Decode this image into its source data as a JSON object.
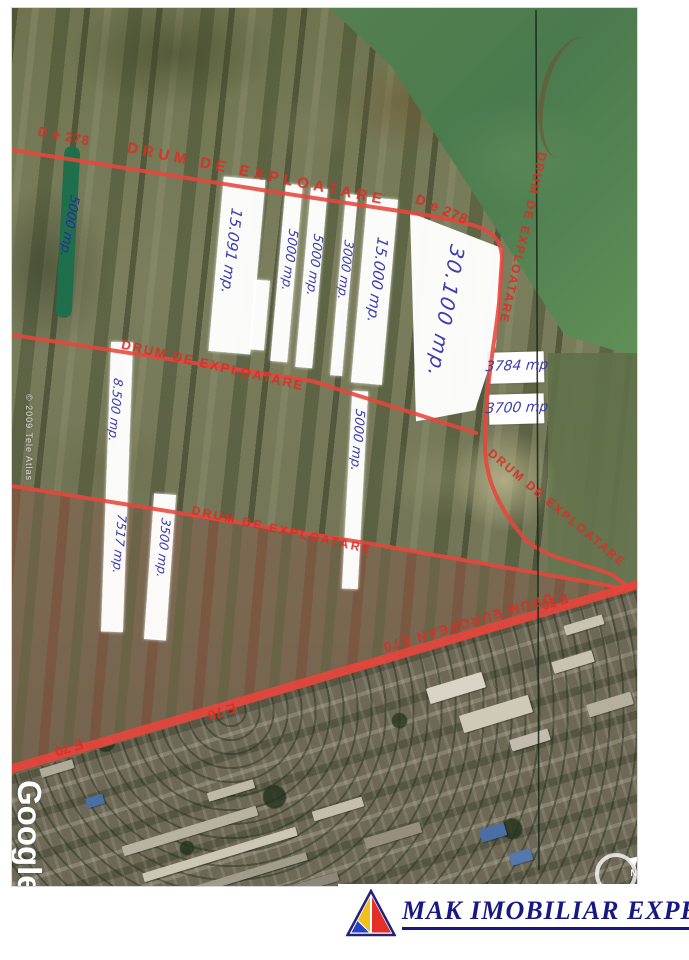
{
  "page": {
    "footer": {
      "company": "MAK IMOBILIAR EXPERT"
    },
    "map": {
      "watermark_copyright": "© 2009 Tele Atlas",
      "watermark_brand": "Google",
      "compass_north": "N",
      "road_labels": [
        {
          "id": "de278-left",
          "text": "D e 278"
        },
        {
          "id": "top-road",
          "text": "DRUM DE EXPLOATARE"
        },
        {
          "id": "de278-top-right",
          "text": "D e 278"
        },
        {
          "id": "right-vertical",
          "text": "DRUM DE EXPLOATARE"
        },
        {
          "id": "middle-road",
          "text": "DRUM DE EXPLOATARE"
        },
        {
          "id": "right-diagonal",
          "text": "DRUM DE EXPLOATARE"
        },
        {
          "id": "lower-road",
          "text": "DRUM DE EXPLOATARE"
        },
        {
          "id": "e70-west",
          "text": "E 70"
        },
        {
          "id": "e70-mid",
          "text": "E 70"
        },
        {
          "id": "drum-european",
          "text": "DRUM EUROPEAN E70"
        },
        {
          "id": "e70-east",
          "text": "E 70"
        }
      ],
      "parcel_labels": [
        {
          "id": "green-strip",
          "text": "5000 mp."
        },
        {
          "id": "p-15091",
          "text": "15.091 mp."
        },
        {
          "id": "p-5000-a",
          "text": "5000 mp."
        },
        {
          "id": "p-5000-b",
          "text": "5000 mp."
        },
        {
          "id": "p-3000",
          "text": "3000 mp."
        },
        {
          "id": "p-15000",
          "text": "15.000 mp."
        },
        {
          "id": "p-30100",
          "text": "30.100 mp."
        },
        {
          "id": "p-8500",
          "text": "8.500 mp."
        },
        {
          "id": "p-5000-c",
          "text": "5000 mp."
        },
        {
          "id": "p-7517",
          "text": "7517 mp."
        },
        {
          "id": "p-3500",
          "text": "3500 mp."
        },
        {
          "id": "box-3784",
          "text": "3784 mp"
        },
        {
          "id": "box-3700",
          "text": "3700 mp"
        }
      ],
      "colors": {
        "road_red": "#e8453c",
        "handwriting_blue": "#3d3dae",
        "road_text_red": "#d43a2f",
        "logo_navy": "#181884",
        "logo_yellow": "#f2c01d",
        "logo_red": "#e23028",
        "logo_blue": "#2742c8"
      }
    }
  }
}
